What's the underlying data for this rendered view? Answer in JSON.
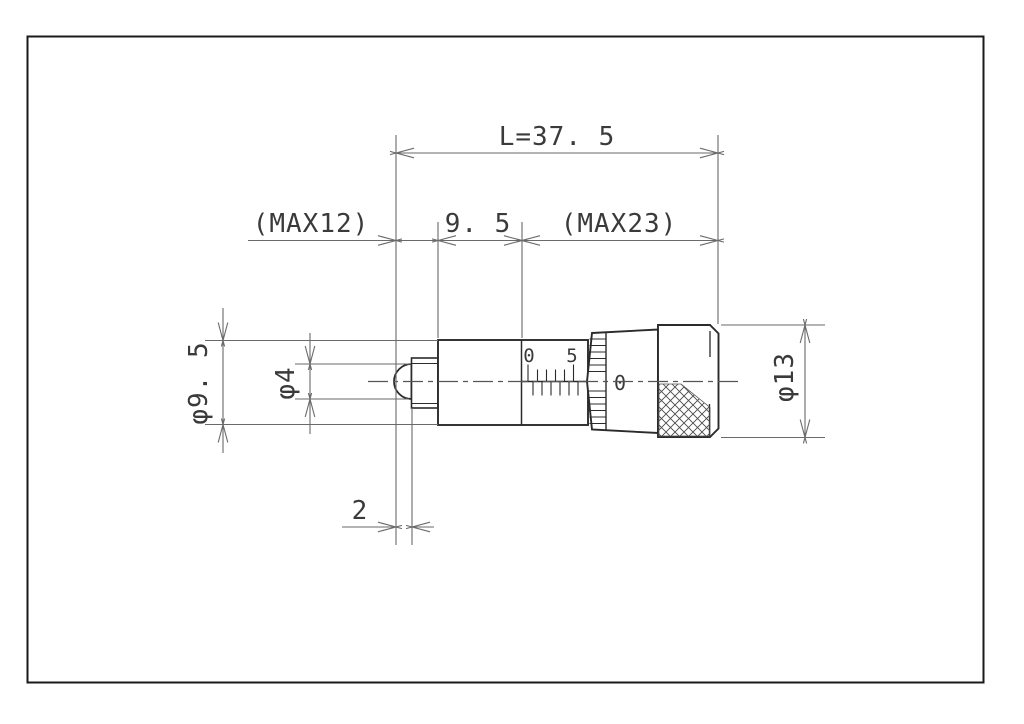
{
  "labels": {
    "overall_length": "L=37. 5",
    "max_retract": "(MAX12)",
    "stem_length": "9. 5",
    "max_travel": "(MAX23)",
    "stem_diameter": "φ9. 5",
    "spindle_tip_diameter": "φ4",
    "thimble_diameter": "φ13",
    "tip_protrusion": "2",
    "sleeve_scale_zero": "0",
    "sleeve_scale_five": "5",
    "thimble_scale_zero": "0"
  },
  "colors": {
    "background": "#ffffff",
    "part_outline": "#2b2b2b",
    "dimension_lines": "#6a6a6a",
    "text": "#3a3a3a"
  }
}
